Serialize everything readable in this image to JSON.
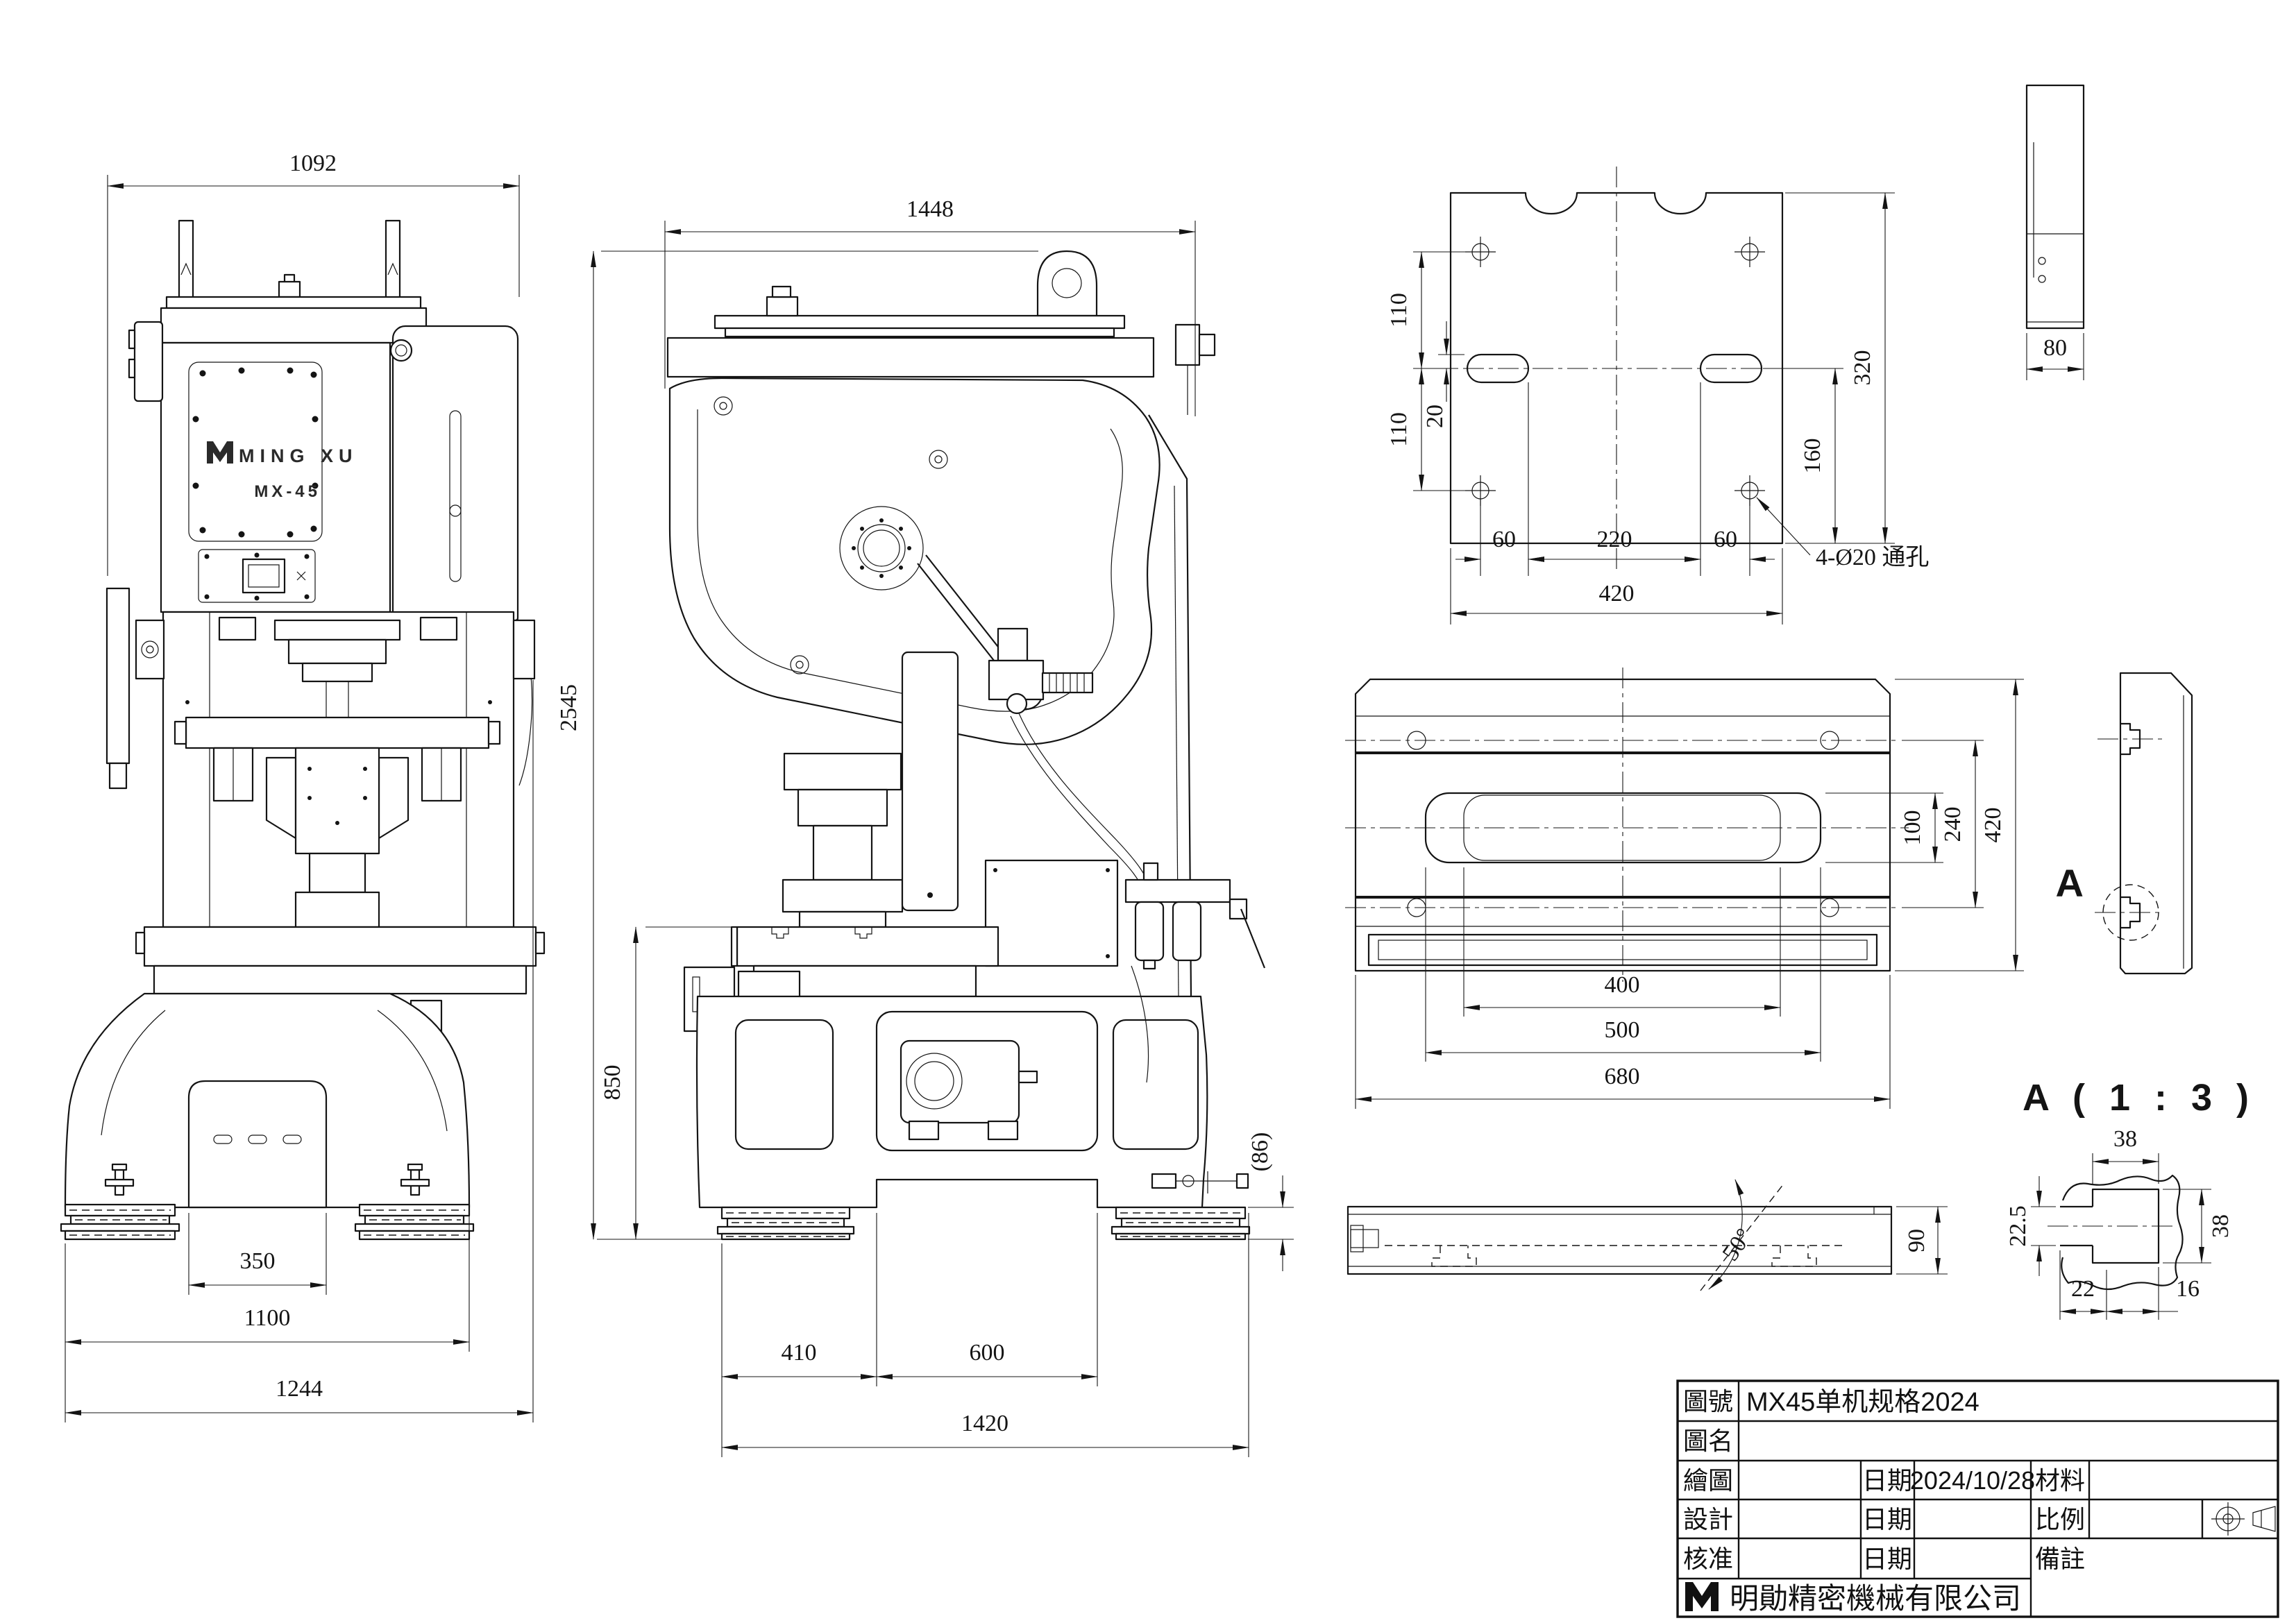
{
  "sheet": {
    "background": "#ffffff",
    "line_color": "#141414"
  },
  "machine": {
    "brand": "MING XU",
    "model": "MX-45"
  },
  "dims": {
    "front": {
      "overall_width": "1092",
      "pedestal_width": "350",
      "feet_span": "1100",
      "overall": "1244"
    },
    "side": {
      "overall_depth": "1448",
      "overall_height": "2545",
      "table_height": "850",
      "base_front": "410",
      "base_opening": "600",
      "base_depth": "1420",
      "pad_height": "(86)"
    },
    "plate": {
      "hole_row_top": "110",
      "slot_offset": "20",
      "hole_row_bottom": "110",
      "span_left": "60",
      "span_center": "220",
      "span_right": "60",
      "width": "420",
      "slot_to_edge": "160",
      "depth": "320",
      "thickness": "80",
      "hole_note": "4-Ø20 通孔"
    },
    "bolster_top": {
      "slot_height": "100",
      "hole_rows": "240",
      "depth": "420",
      "slot_span": "400",
      "outer_span": "500",
      "width": "680"
    },
    "bolster_front": {
      "angle": "50°",
      "height": "90"
    },
    "detail_a": {
      "view_label": "A",
      "title": "A ( 1 : 3 )",
      "slot_top_width": "38",
      "throat_height": "22.5",
      "cavity_height": "38",
      "bottom_left": "22",
      "bottom_right": "16"
    }
  },
  "title_block": {
    "labels": {
      "drawing_no": "圖號",
      "drawing_name": "圖名",
      "drawn": "繪圖",
      "designed": "設計",
      "approved": "核准",
      "date1": "日期",
      "date2": "日期",
      "date3": "日期",
      "material": "材料",
      "scale": "比例",
      "remarks": "備註"
    },
    "values": {
      "drawing_no": "MX45单机规格2024",
      "drawing_name": "",
      "drawn_by": "",
      "drawn_date": "2024/10/28",
      "designed_by": "",
      "designed_date": "",
      "approved_by": "",
      "approved_date": "",
      "material": "",
      "scale": "",
      "remarks": ""
    },
    "company": "明勛精密機械有限公司"
  }
}
